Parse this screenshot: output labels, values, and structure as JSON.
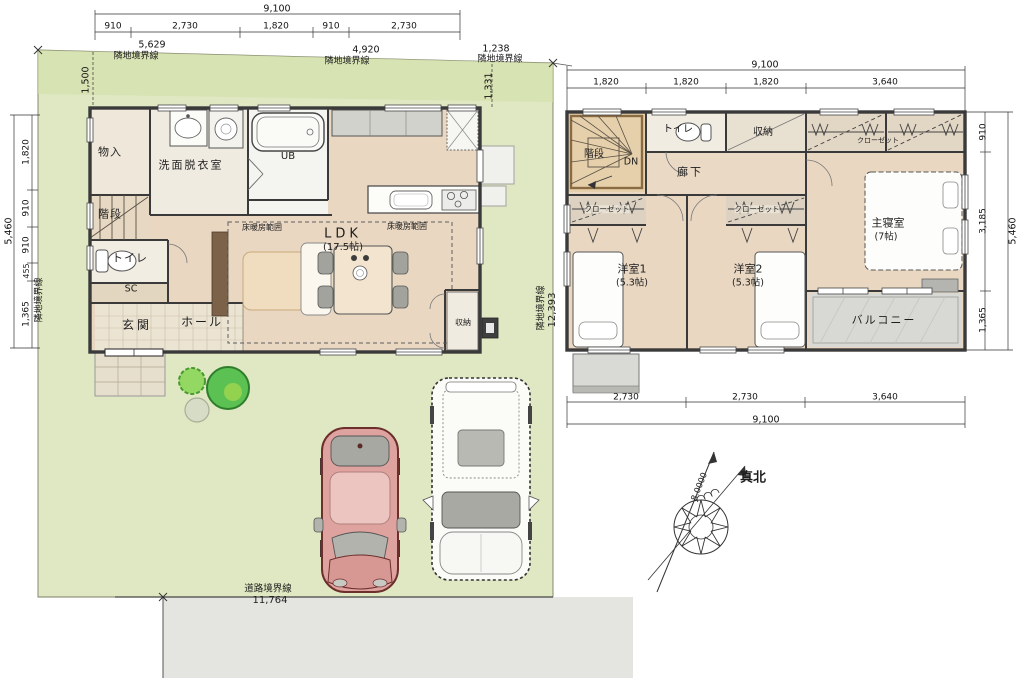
{
  "palette": {
    "site_green": "#dfe8c2",
    "site_green_shade": "#d2e1ab",
    "road_gray": "#e4e4e1",
    "floor_tan": "#e9d7c2",
    "room_light": "#f1ece2",
    "wall_dark": "#3a3a3a",
    "car_red": "#dfa39f",
    "tree_green": "#5cc153",
    "balcony_gray": "#d8d8d4"
  },
  "site": {
    "boundary_top_left": {
      "value": "5,629",
      "label": "隣地境界線"
    },
    "boundary_top_mid": {
      "value": "4,920",
      "label": "隣地境界線"
    },
    "boundary_top_right": {
      "value": "1,238",
      "label": "隣地境界線"
    },
    "boundary_left_label": "隣地境界線",
    "boundary_right": {
      "value": "12,393",
      "label": "隣地境界線"
    },
    "road": {
      "value": "11,764",
      "label": "道路境界線"
    },
    "offset_top_left": "1,500",
    "offset_top_right": "1,331"
  },
  "north": {
    "label": "真北",
    "angle": "8.0000"
  },
  "floor1": {
    "dims_top": {
      "total": "9,100",
      "segments": [
        "910",
        "2,730",
        "1,820",
        "910",
        "2,730"
      ]
    },
    "dims_left": {
      "total": "5,460",
      "segments": [
        "1,820",
        "910",
        "910",
        "455",
        "1,365"
      ]
    },
    "rooms": {
      "storage": "物入",
      "washroom": "洗面脱衣室",
      "bath": "UB",
      "stairs": "階段",
      "toilet": "トイレ",
      "shoe_closet": "SC",
      "entrance": "玄関",
      "hall": "ホール",
      "ldk": "LDK",
      "ldk_size": "(17.5帖)",
      "floor_heating_1": "床暖房範囲",
      "floor_heating_2": "床暖房範囲",
      "closet": "収納"
    }
  },
  "floor2": {
    "dims_top": {
      "total": "9,100",
      "segments": [
        "1,820",
        "1,820",
        "1,820",
        "3,640"
      ]
    },
    "dims_bottom": {
      "total": "9,100",
      "segments": [
        "2,730",
        "2,730",
        "3,640"
      ]
    },
    "dims_right": {
      "total": "5,460",
      "segments": [
        "910",
        "3,185",
        "1,365"
      ]
    },
    "rooms": {
      "stairs": "階段",
      "down": "DN",
      "toilet": "トイレ",
      "storage": "収納",
      "hallway": "廊下",
      "closet_top": "クローゼット",
      "closet_1": "クローゼット",
      "closet_2": "クローゼット",
      "bedroom1": "洋室1",
      "bedroom1_size": "(5.3帖)",
      "bedroom2": "洋室2",
      "bedroom2_size": "(5.3帖)",
      "master": "主寝室",
      "master_size": "(7帖)",
      "balcony": "バルコニー"
    }
  }
}
